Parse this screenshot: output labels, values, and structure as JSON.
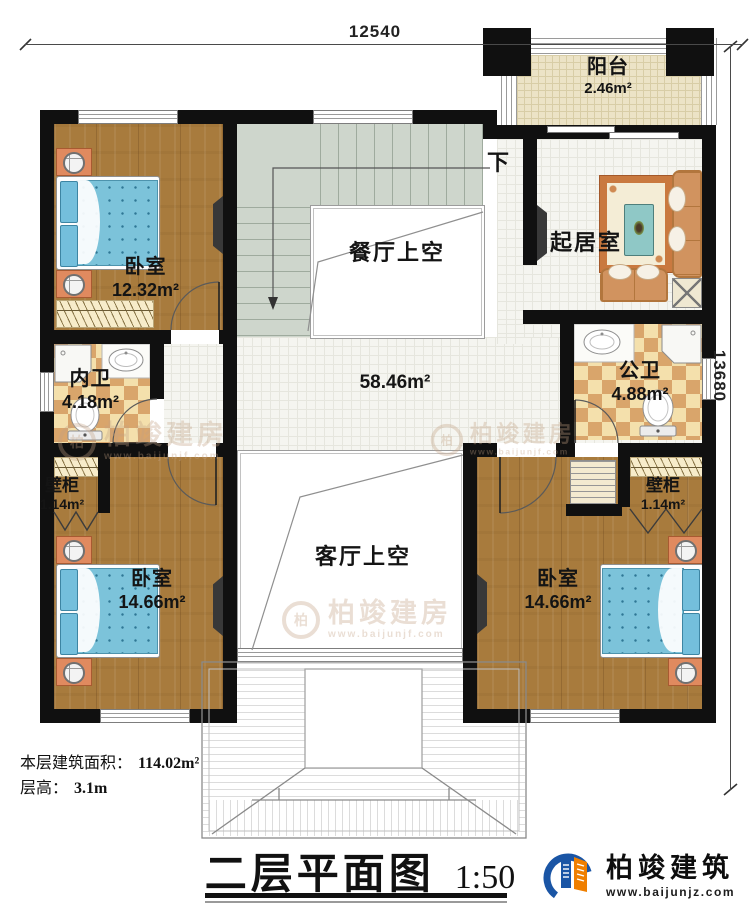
{
  "dimensions": {
    "width_top": "12540",
    "height_right": "13680"
  },
  "labels": {
    "down": "下"
  },
  "rooms": {
    "balcony": {
      "name": "阳台",
      "area": "2.46m²"
    },
    "bedroom_top_left": {
      "name": "卧室",
      "area": "12.32m²"
    },
    "dining_void": {
      "name": "餐厅上空"
    },
    "living_room": {
      "name": "起居室"
    },
    "hall": {
      "area": "58.46m²"
    },
    "inner_bathroom": {
      "name": "内卫",
      "area": "4.18m²"
    },
    "public_bathroom": {
      "name": "公卫",
      "area": "4.88m²"
    },
    "closet_left": {
      "name": "壁柜",
      "area": "1.14m²"
    },
    "closet_right": {
      "name": "壁柜",
      "area": "1.14m²"
    },
    "bedroom_bottom_left": {
      "name": "卧室",
      "area": "14.66m²"
    },
    "bedroom_bottom_right": {
      "name": "卧室",
      "area": "14.66m²"
    },
    "living_void": {
      "name": "客厅上空"
    }
  },
  "footer": {
    "floor_area_label": "本层建筑面积：",
    "floor_area_value": "114.02m²",
    "floor_height_label": "层高：",
    "floor_height_value": "3.1m",
    "title": "二层平面图",
    "scale": "1:50"
  },
  "brand": {
    "name": "柏竣建筑",
    "website": "www.baijunjz.com"
  },
  "watermark": {
    "name": "柏竣建房",
    "website": "www.baijunjf.com",
    "ring_glyph": "柏"
  },
  "colors": {
    "wall": "#101010",
    "wood": "#a87b3d",
    "stair": "#ced6cc",
    "tile": "#f5f5f0",
    "checker_light": "#f4e0ac",
    "checker_dark": "#d9a56b",
    "bed": "#7cc3da",
    "logo_blue": "#1a55a5",
    "logo_orange": "#ef7f00"
  }
}
